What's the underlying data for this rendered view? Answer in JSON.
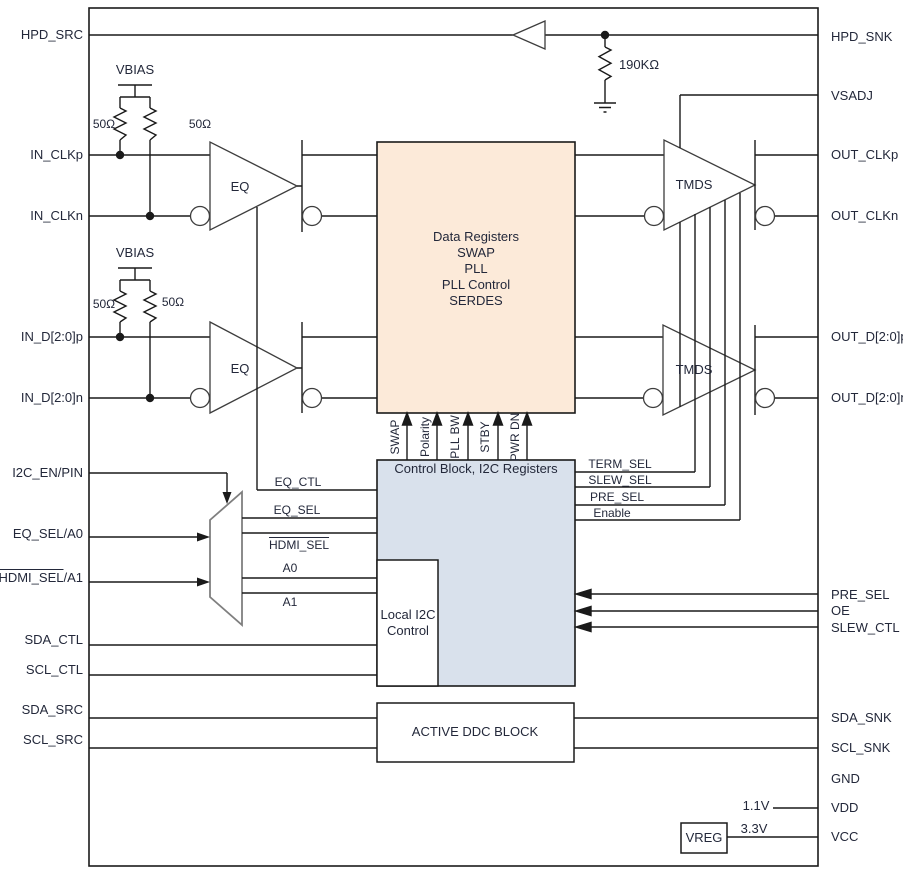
{
  "colors": {
    "serdes_fill": "#fcead9",
    "control_fill": "#d9e1ec"
  },
  "pins": {
    "left": {
      "hpd_src": "HPD_SRC",
      "in_clkp": "IN_CLKp",
      "in_clkn": "IN_CLKn",
      "in_dp": "IN_D[2:0]p",
      "in_dn": "IN_D[2:0]n",
      "i2c_en": "I2C_EN/PIN",
      "eq_sel_a0": "EQ_SEL/A0",
      "hdmi_sel_a1_over": "HDMI_SEL",
      "hdmi_sel_a1_rest": "/A1",
      "sda_ctl": "SDA_CTL",
      "scl_ctl": "SCL_CTL",
      "sda_src": "SDA_SRC",
      "scl_src": "SCL_SRC"
    },
    "right": {
      "hpd_snk": "HPD_SNK",
      "vsadj": "VSADJ",
      "out_clkp": "OUT_CLKp",
      "out_clkn": "OUT_CLKn",
      "out_dp": "OUT_D[2:0]p",
      "out_dn": "OUT_D[2:0]n",
      "pre_sel": "PRE_SEL",
      "oe": "OE",
      "slew_ctl": "SLEW_CTL",
      "sda_snk": "SDA_SNK",
      "scl_snk": "SCL_SNK",
      "gnd": "GND",
      "vdd": "VDD",
      "vcc": "VCC"
    }
  },
  "blocks": {
    "serdes": {
      "line1": "Data Registers",
      "line2": "SWAP",
      "line3": "PLL",
      "line4": "PLL Control",
      "line5": "SERDES"
    },
    "control": {
      "title": "Control Block, I2C Registers"
    },
    "local_i2c": {
      "line1": "Local I2C",
      "line2": "Control"
    },
    "ddc": {
      "label": "ACTIVE DDC BLOCK"
    },
    "vreg": {
      "label": "VREG"
    }
  },
  "amps": {
    "eq": "EQ",
    "tmds": "TMDS"
  },
  "nets": {
    "eq_ctl": "EQ_CTL",
    "eq_sel": "EQ_SEL",
    "hdmi_sel": "HDMI_SEL",
    "a0": "A0",
    "a1": "A1",
    "term_sel": "TERM_SEL",
    "slew_sel": "SLEW_SEL",
    "pre_sel": "PRE_SEL",
    "enable": "Enable",
    "swap": "SWAP",
    "polarity": "Polarity",
    "pll_bw": "PLL BW",
    "stby": "STBY",
    "pwr_dn": "PWR DN"
  },
  "parts": {
    "vbias": "VBIAS",
    "r_term": "50Ω",
    "r_hpd": "190KΩ",
    "v_core": "1.1V",
    "v_supply": "3.3V"
  }
}
